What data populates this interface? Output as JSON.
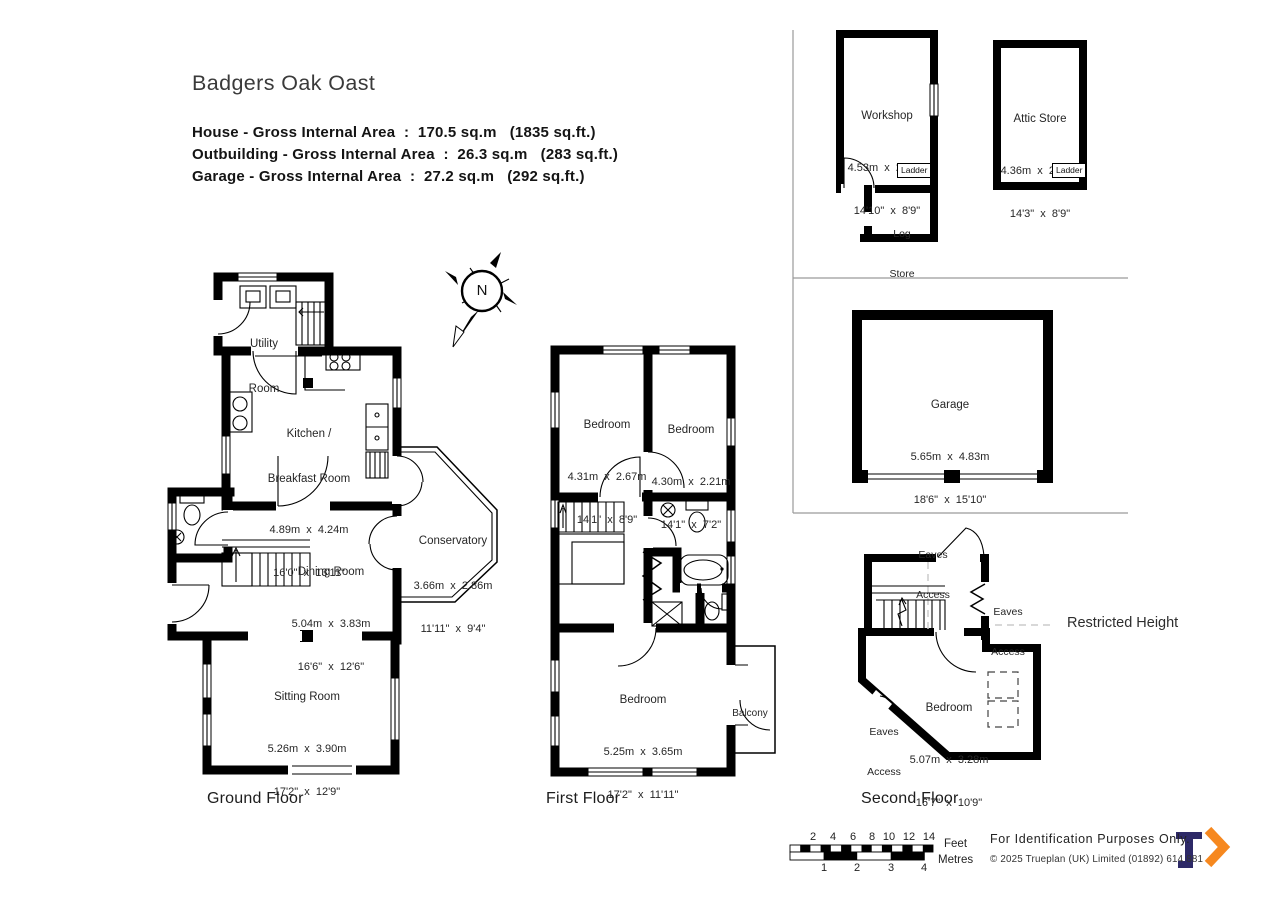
{
  "header": {
    "title": "Badgers Oak Oast",
    "area_lines": [
      "House - Gross Internal Area  :  170.5 sq.m   (1835 sq.ft.)",
      "Outbuilding - Gross Internal Area  :  26.3 sq.m   (283 sq.ft.)",
      "Garage - Gross Internal Area  :  27.2 sq.m   (292 sq.ft.)"
    ]
  },
  "compass": {
    "north": "N"
  },
  "ground_floor": {
    "label": "Ground Floor",
    "utility": {
      "line1": "Utility",
      "line2": "Room"
    },
    "kitchen": {
      "line1": "Kitchen /",
      "line2": "Breakfast Room",
      "dims_m": "4.89m  x  4.24m",
      "dims_ft": "16'0\"  x  13'11\""
    },
    "dining": {
      "name": "Dining Room",
      "dims_m": "5.04m  x  3.83m",
      "dims_ft": "16'6\"  x  12'6\""
    },
    "conservatory": {
      "name": "Conservatory",
      "dims_m": "3.66m  x  2.86m",
      "dims_ft": "11'11\"  x  9'4\""
    },
    "sitting": {
      "name": "Sitting Room",
      "dims_m": "5.26m  x  3.90m",
      "dims_ft": "17'2\"  x  12'9\""
    }
  },
  "first_floor": {
    "label": "First Floor",
    "bedroom1": {
      "name": "Bedroom",
      "dims_m": "4.31m  x  2.67m",
      "dims_ft": "14'1\"  x  8'9\""
    },
    "bedroom2": {
      "name": "Bedroom",
      "dims_m": "4.30m  x  2.21m",
      "dims_ft": "14'1\"  x  7'2\""
    },
    "bedroom3": {
      "name": "Bedroom",
      "dims_m": "5.25m  x  3.65m",
      "dims_ft": "17'2\"  x  11'11\""
    },
    "balcony": {
      "name": "Balcony"
    }
  },
  "second_floor": {
    "label": "Second Floor",
    "bedroom": {
      "name": "Bedroom",
      "dims_m": "5.07m  x  3.28m",
      "dims_ft": "16'7\"  x  10'9\""
    },
    "eaves_top": {
      "line1": "Eaves",
      "line2": "Access"
    },
    "eaves_right": {
      "line1": "Eaves",
      "line2": "Access"
    },
    "eaves_left": {
      "line1": "Eaves",
      "line2": "Access"
    },
    "restricted_height": "Restricted Height"
  },
  "outbuilding": {
    "workshop": {
      "name": "Workshop",
      "dims_m": "4.53m  x  2.68m",
      "dims_ft": "14'10\"  x  8'9\""
    },
    "log_store": {
      "line1": "Log",
      "line2": "Store"
    },
    "attic_store": {
      "name": "Attic Store",
      "dims_m": "4.36m  x  2.68m",
      "dims_ft": "14'3\"  x  8'9\""
    },
    "ladder_workshop": "Ladder",
    "ladder_attic": "Ladder"
  },
  "garage": {
    "name": "Garage",
    "dims_m": "5.65m  x  4.83m",
    "dims_ft": "18'6\"  x  15'10\""
  },
  "scale_bar": {
    "feet_ticks": [
      "2",
      "4",
      "6",
      "8",
      "10",
      "12",
      "14"
    ],
    "metre_ticks": [
      "1",
      "2",
      "3",
      "4"
    ],
    "feet_label": "Feet",
    "metres_label": "Metres"
  },
  "footer": {
    "identification": "For  Identification  Purposes  Only.",
    "copyright": "©  2025 Trueplan (UK) Limited   (01892) 614 881"
  },
  "brand": {
    "navy": "#2d2967",
    "orange": "#f6881f"
  }
}
